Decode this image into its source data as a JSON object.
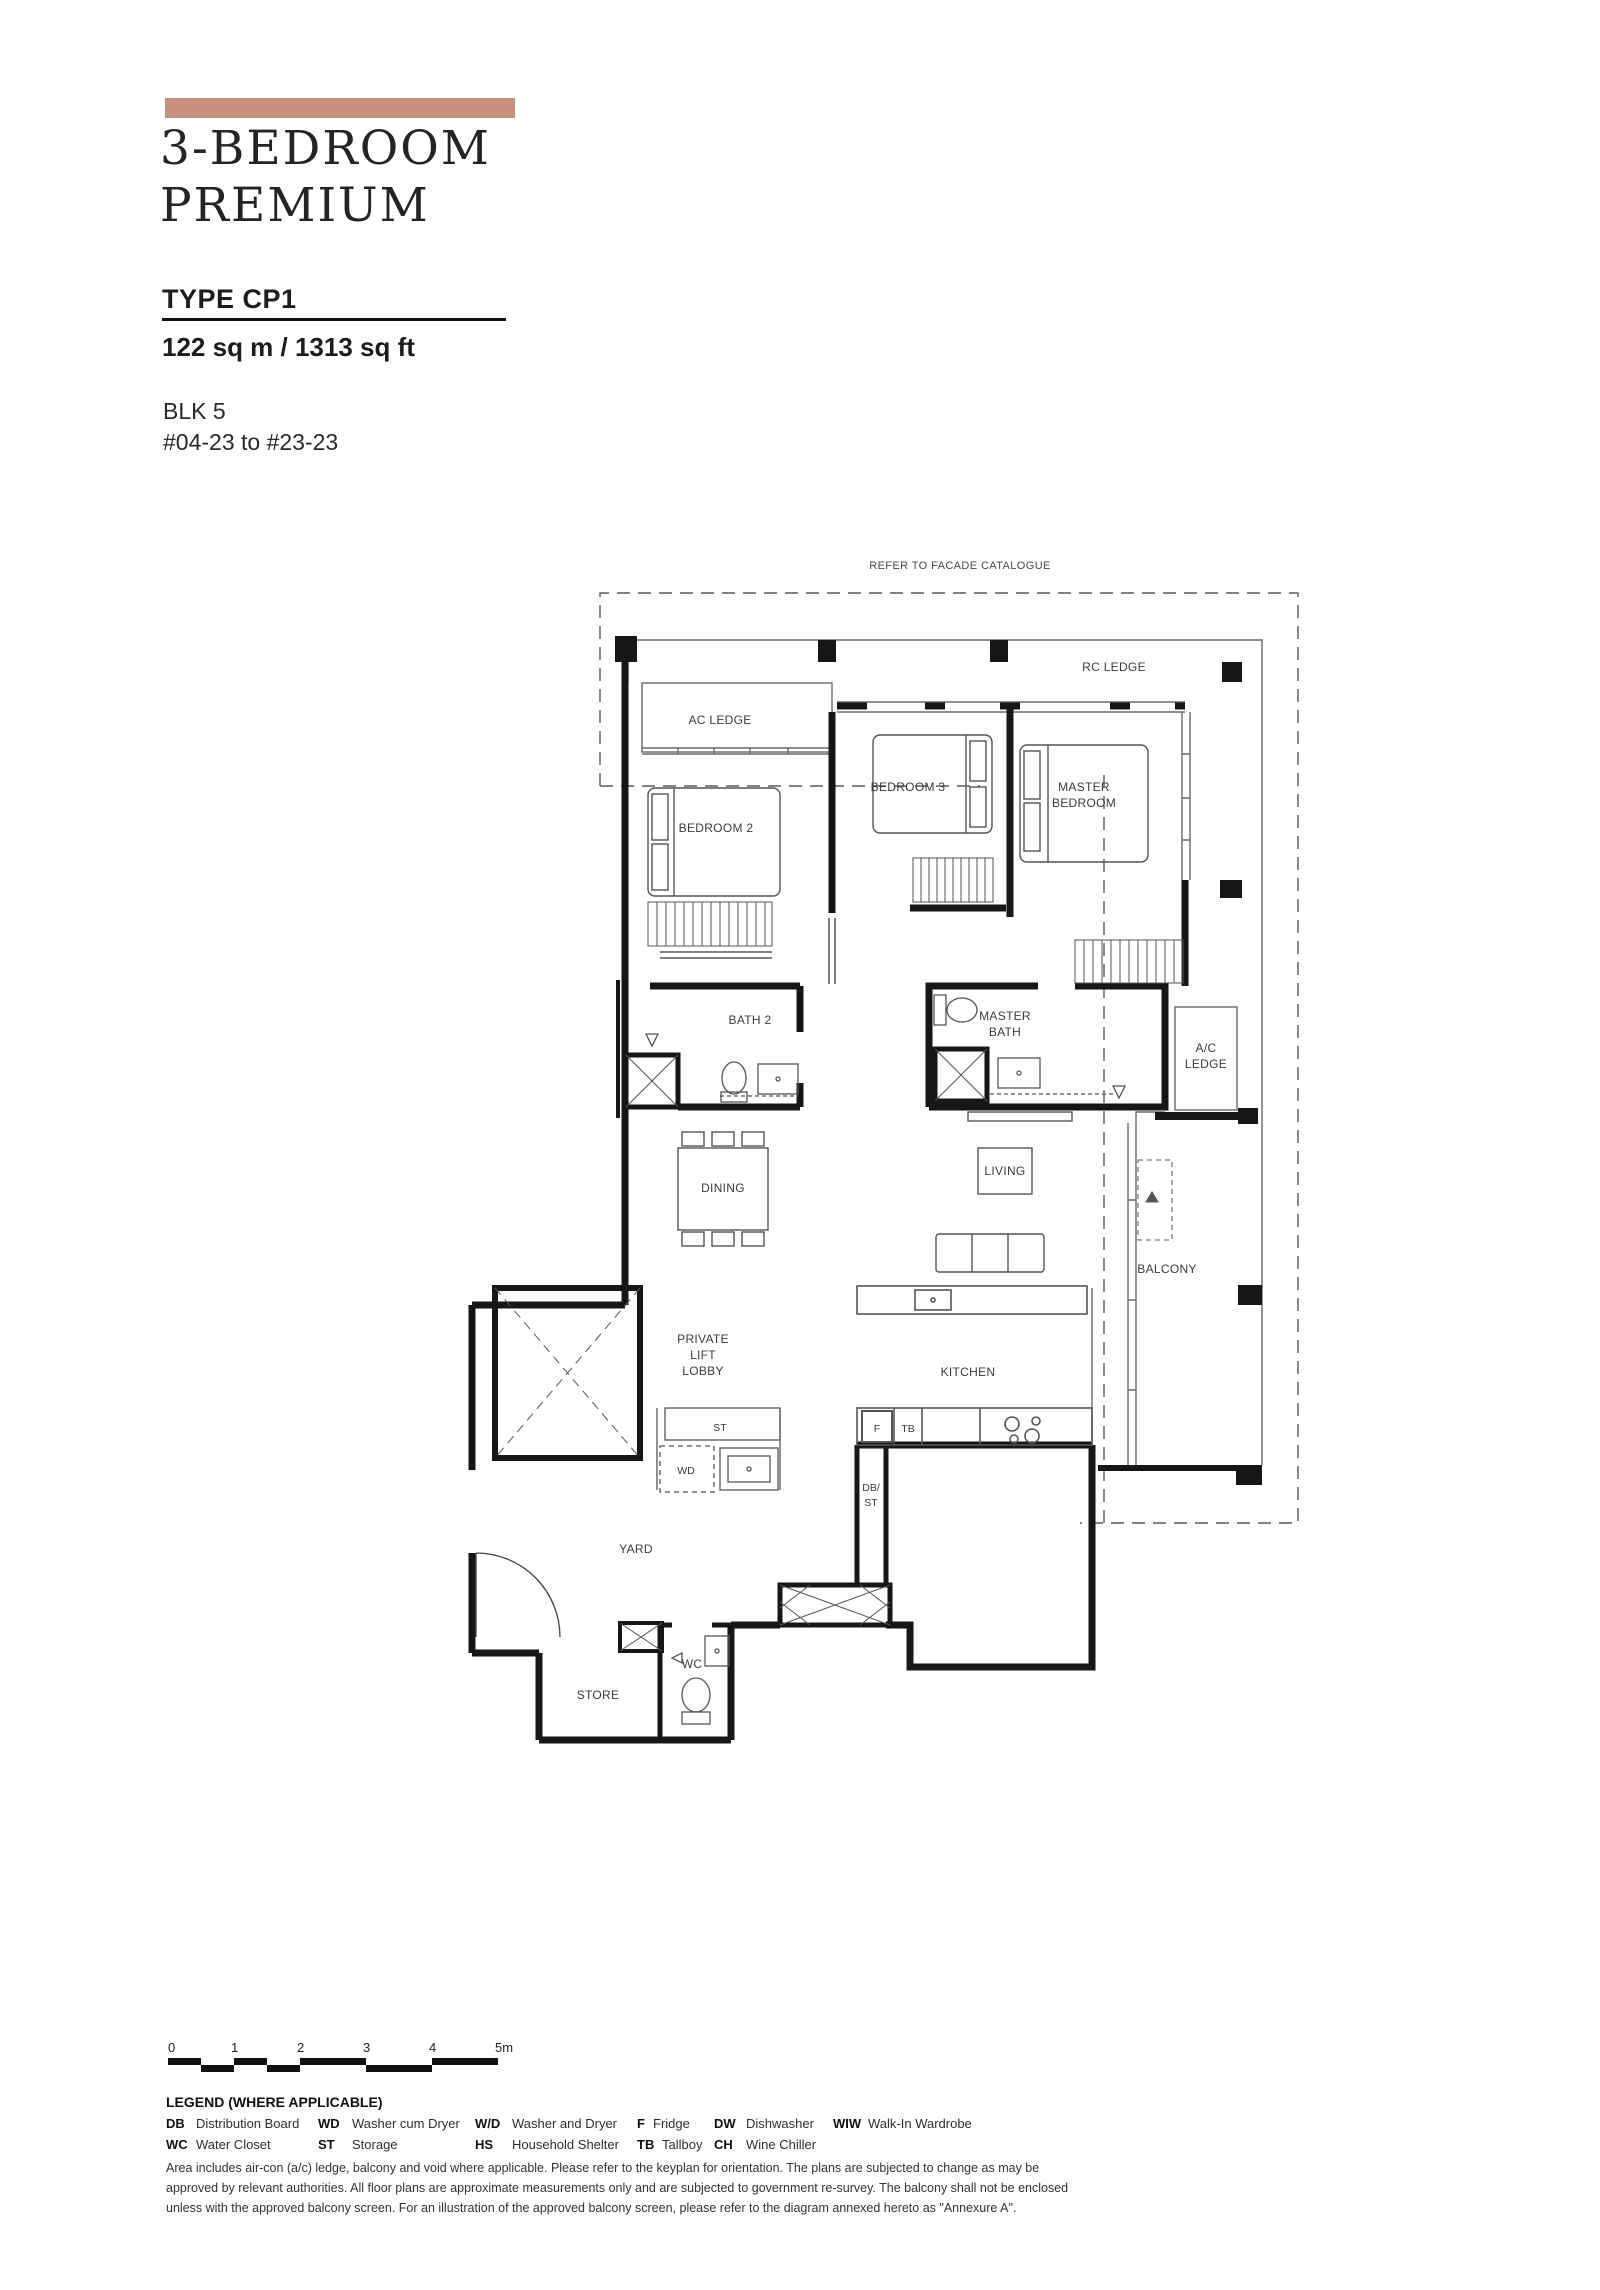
{
  "page": {
    "background": "#ffffff"
  },
  "header": {
    "accent_bar_color": "#c68f7e",
    "title_line1": "3-BEDROOM",
    "title_line2": "PREMIUM",
    "type_label": "TYPE CP1",
    "area_label": "122 sq m / 1313 sq ft",
    "block_label": "BLK 5",
    "unit_range_label": "#04-23 to #23-23"
  },
  "plan": {
    "facade_note": "REFER TO FACADE CATALOGUE",
    "labels": {
      "rc_ledge": "RC LEDGE",
      "ac_ledge": "AC LEDGE",
      "bedroom_3": "BEDROOM 3",
      "master_bedroom": [
        "MASTER",
        "BEDROOM"
      ],
      "bedroom_2": "BEDROOM 2",
      "bath_2": "BATH 2",
      "master_bath": [
        "MASTER",
        "BATH"
      ],
      "ac_ledge_2": [
        "A/C",
        "LEDGE"
      ],
      "dining": "DINING",
      "living": "LIVING",
      "balcony": "BALCONY",
      "private_lift_lobby": [
        "PRIVATE",
        "LIFT",
        "LOBBY"
      ],
      "kitchen": "KITCHEN",
      "st": "ST",
      "wd": "WD",
      "f": "F",
      "tb": "TB",
      "db_st": [
        "DB/",
        "ST"
      ],
      "yard": "YARD",
      "wc": "WC",
      "store": "STORE"
    }
  },
  "scale_bar": {
    "labels": [
      "0",
      "1",
      "2",
      "3",
      "4",
      "5m"
    ]
  },
  "legend": {
    "title": "LEGEND (WHERE APPLICABLE)",
    "row1": [
      {
        "abbr": "DB",
        "desc": "Distribution Board"
      },
      {
        "abbr": "WD",
        "desc": "Washer cum Dryer"
      },
      {
        "abbr": "W/D",
        "desc": "Washer and Dryer"
      },
      {
        "abbr": "F",
        "desc": "Fridge"
      },
      {
        "abbr": "DW",
        "desc": "Dishwasher"
      },
      {
        "abbr": "WIW",
        "desc": "Walk-In Wardrobe"
      }
    ],
    "row2": [
      {
        "abbr": "WC",
        "desc": "Water Closet"
      },
      {
        "abbr": "ST",
        "desc": "Storage"
      },
      {
        "abbr": "HS",
        "desc": "Household Shelter"
      },
      {
        "abbr": "TB",
        "desc": "Tallboy"
      },
      {
        "abbr": "CH",
        "desc": "Wine Chiller"
      }
    ]
  },
  "disclaimer": {
    "line1": "Area includes air-con (a/c) ledge, balcony and void where applicable. Please refer to the keyplan for orientation. The plans are subjected to change as may be",
    "line2": "approved by relevant authorities. All floor plans are approximate measurements only and are subjected to government re-survey. The balcony shall not be enclosed",
    "line3": "unless with the approved balcony screen. For an illustration of the approved balcony screen, please refer to the diagram annexed hereto as \"Annexure A\"."
  }
}
